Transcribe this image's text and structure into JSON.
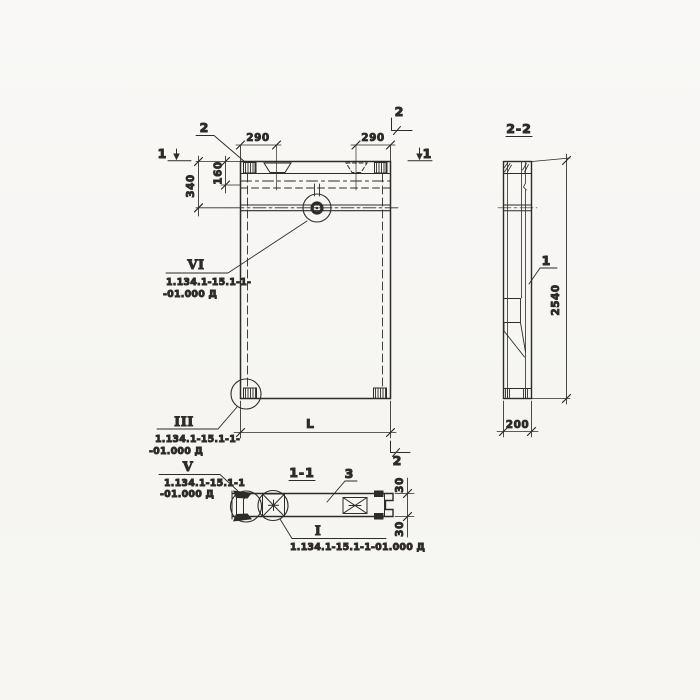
{
  "meta": {
    "background": "#f8f7f5",
    "ink": "#2e2b28",
    "drawing_type": "precast concrete panel working drawing"
  },
  "views": {
    "elevation": {
      "callout_2": "2",
      "section_mark_left": "1",
      "section_mark_right": "1",
      "section_mark_top": "2",
      "section_mark_bottom": "2",
      "dim_290_left": "290",
      "dim_290_right": "290",
      "dim_340": "340",
      "dim_160": "160",
      "dim_length": "L",
      "detail_vi": {
        "numeral": "VI",
        "ref_line1": "1.134.1-15.1-1-",
        "ref_line2": "-01.000 Д"
      },
      "detail_iii": {
        "numeral": "III",
        "ref_line1": "1.134.1-15.1-1-",
        "ref_line2": "-01.000 Д"
      }
    },
    "section_1_1": {
      "title": "1-1",
      "part_3": "3",
      "dim_30_top": "30",
      "dim_30_bottom": "30",
      "detail_v": {
        "numeral": "V",
        "ref_line1": "1.134.1-15.1-1",
        "ref_line2": "-01.000 Д"
      },
      "detail_i": {
        "numeral": "I",
        "ref": "1.134.1-15.1-1-01.000 Д"
      }
    },
    "section_2_2": {
      "title": "2-2",
      "part_1": "1",
      "dim_2540": "2540",
      "dim_200": "200"
    }
  }
}
